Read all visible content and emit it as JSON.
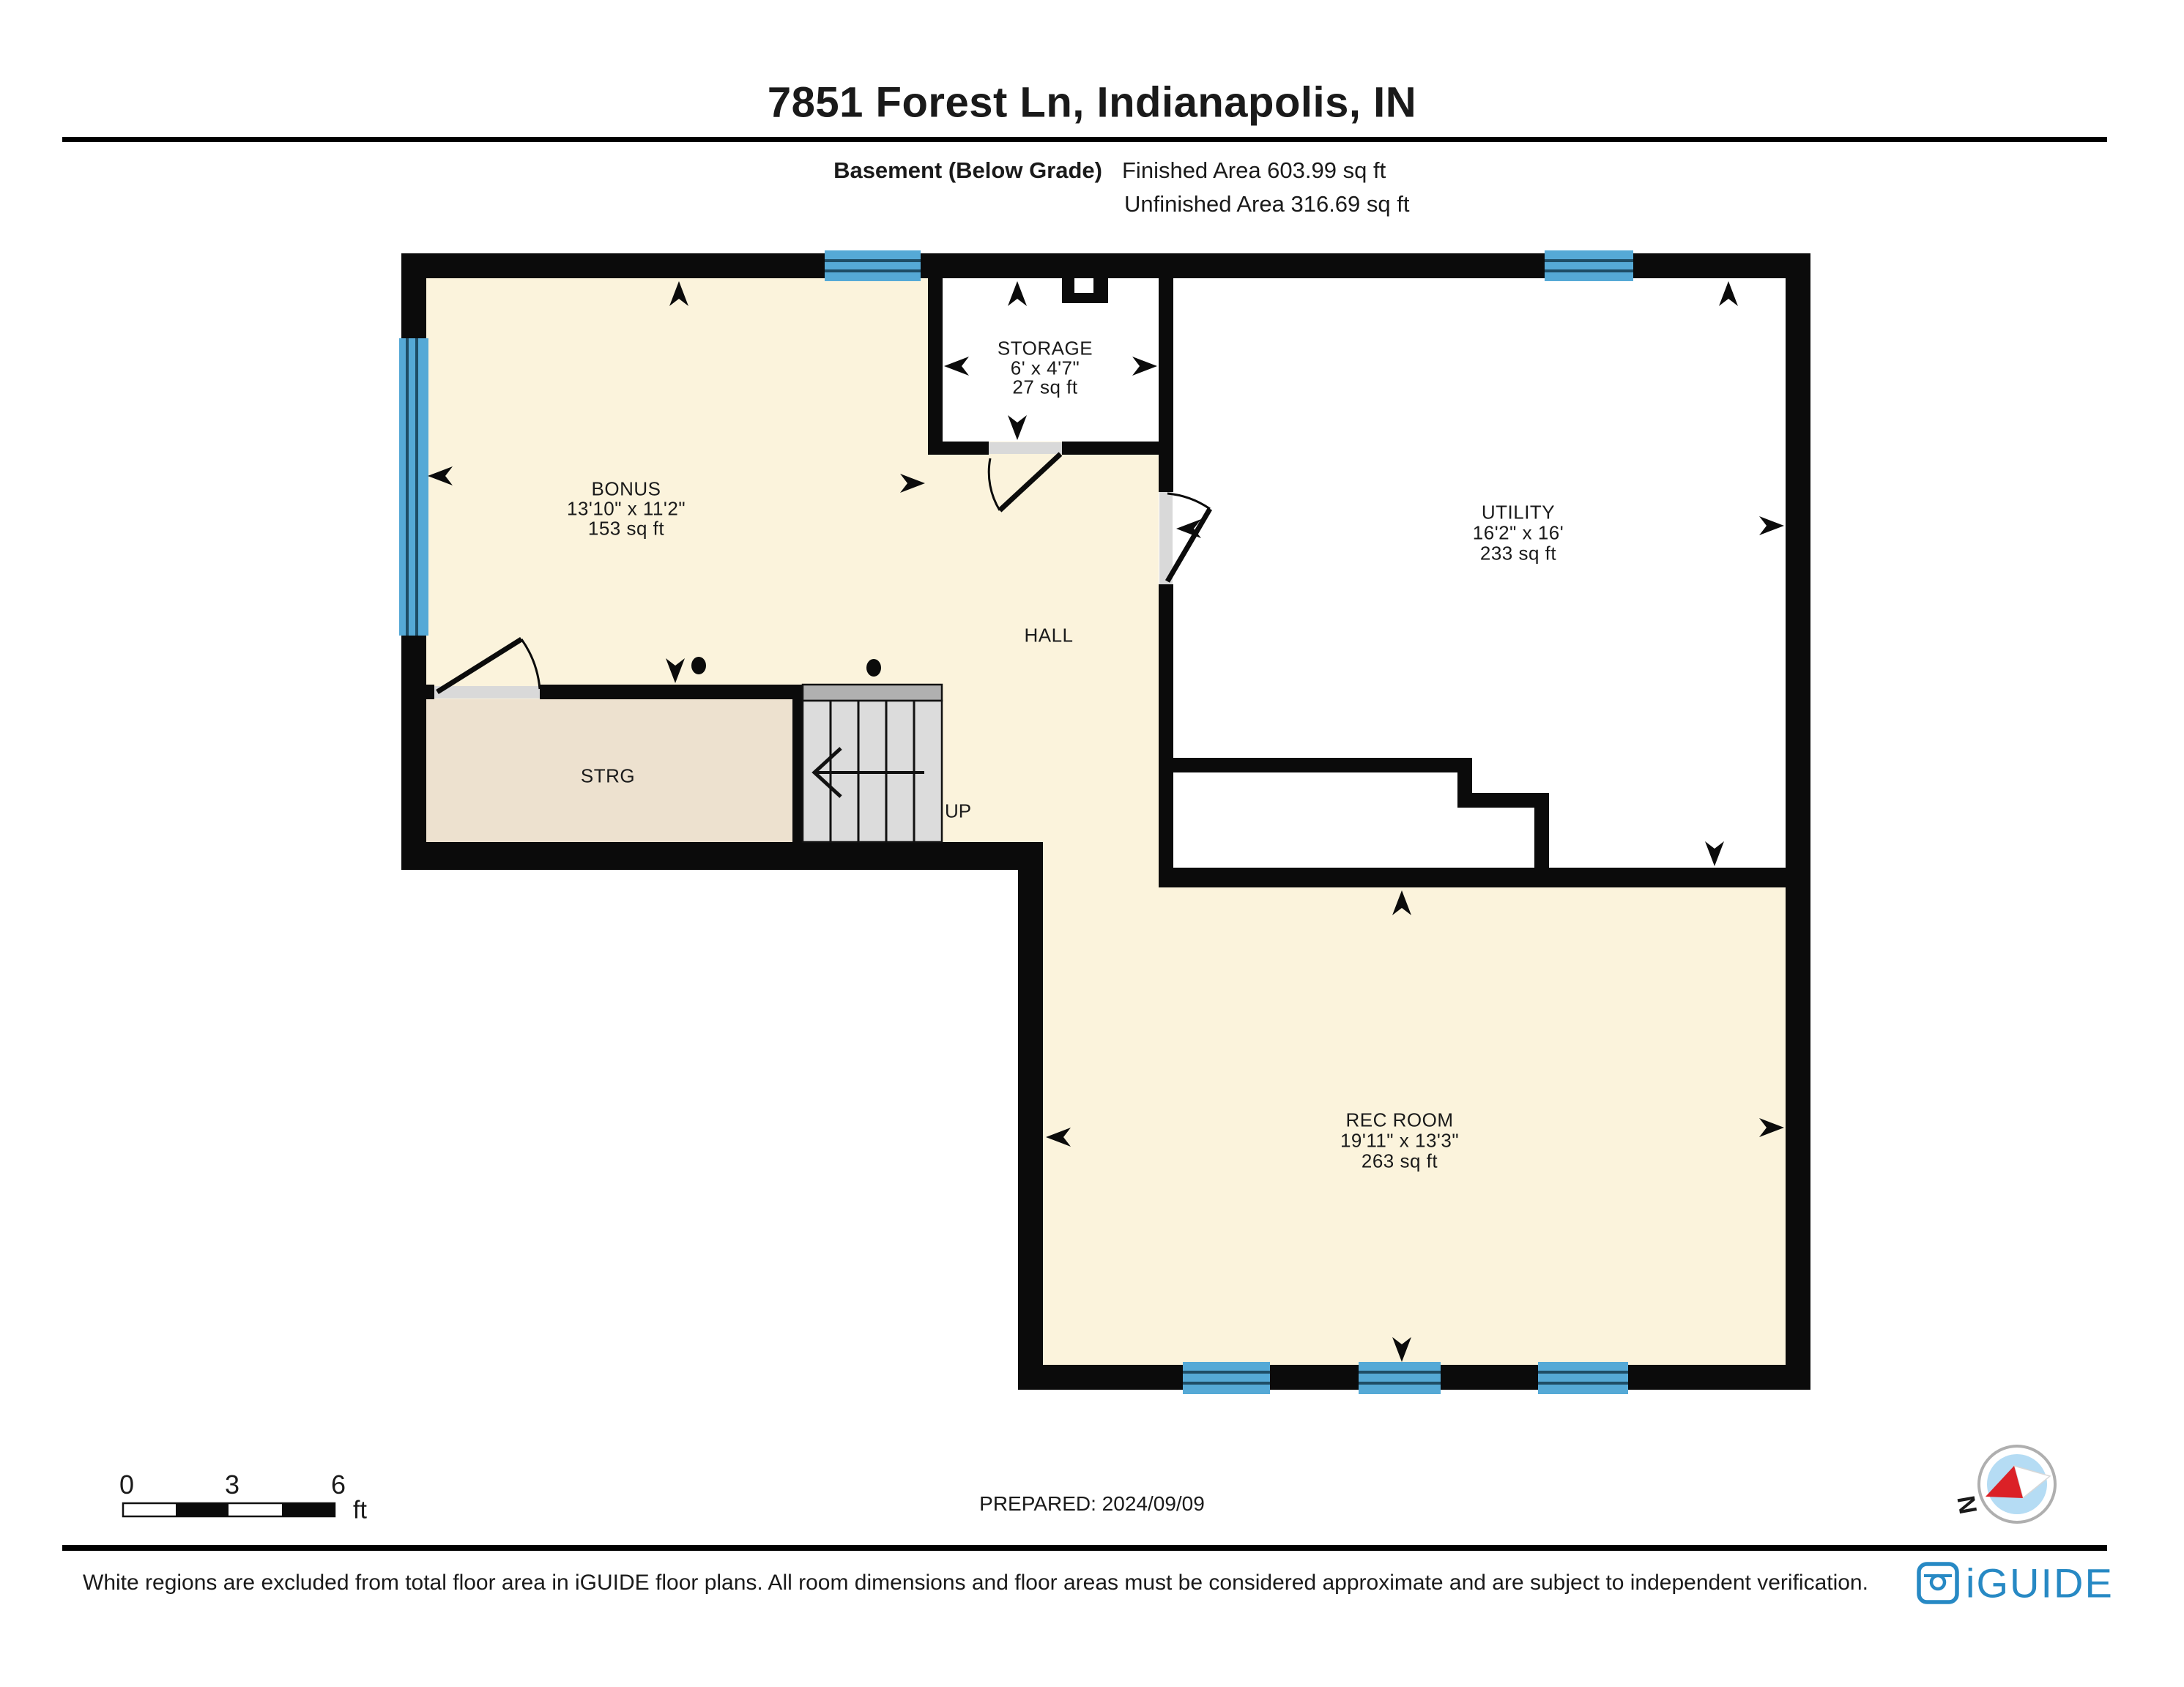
{
  "header": {
    "title": "7851 Forest Ln, Indianapolis, IN",
    "floor_label": "Basement (Below Grade)",
    "finished_area": "Finished Area 603.99 sq ft",
    "unfinished_area": "Unfinished Area 316.69 sq ft"
  },
  "rooms": {
    "bonus": {
      "name": "BONUS",
      "dimensions": "13'10\" x 11'2\"",
      "area": "153 sq ft"
    },
    "storage": {
      "name": "STORAGE",
      "dimensions": "6' x 4'7\"",
      "area": "27 sq ft"
    },
    "utility": {
      "name": "UTILITY",
      "dimensions": "16'2\" x 16'",
      "area": "233 sq ft"
    },
    "rec_room": {
      "name": "REC ROOM",
      "dimensions": "19'11\" x 13'3\"",
      "area": "263 sq ft"
    },
    "hall": {
      "name": "HALL"
    },
    "strg": {
      "name": "STRG"
    },
    "stairs": {
      "label": "UP"
    }
  },
  "scale_bar": {
    "tick_0": "0",
    "tick_3": "3",
    "tick_6": "6",
    "unit": "ft"
  },
  "prepared_label": "PREPARED: 2024/09/09",
  "compass": {
    "north_label": "N"
  },
  "footer": {
    "disclaimer": "White regions are excluded from total floor area in iGUIDE floor plans. All room dimensions and floor areas must be considered approximate and are subject to independent verification.",
    "brand": "iGUIDE"
  },
  "colors": {
    "wall": "#0b0b0b",
    "finished_area_fill": "#FBF3DC",
    "unfinished_area_fill": "#FFFFFF",
    "storage_fill": "#EDE1CF",
    "stair_fill": "#DCDCDC",
    "stair_landing_fill": "#B0B0B0",
    "door_sill_fill": "#D9D9D9",
    "window_blue": "#55A9D6",
    "window_mullion": "#1E4D66",
    "brand_blue": "#2789C4",
    "compass_red": "#DB2127"
  }
}
